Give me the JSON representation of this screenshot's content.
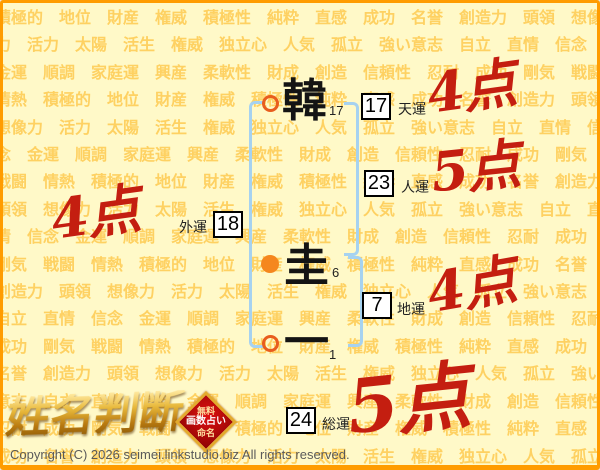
{
  "background": {
    "words": [
      "積極的",
      "地位",
      "財産",
      "権威",
      "積極性",
      "純粋",
      "直感",
      "成功",
      "名誉",
      "創造力",
      "頭領",
      "想像力",
      "活力",
      "太陽",
      "活生",
      "権威",
      "独立心",
      "人気",
      "孤立",
      "強い意志",
      "自立",
      "直情",
      "信念",
      "金運",
      "順調",
      "家庭運",
      "興産",
      "柔軟性",
      "財成",
      "創造",
      "信頼性",
      "忍耐",
      "成功",
      "剛気",
      "戦闘",
      "情熱"
    ]
  },
  "name": {
    "chars": [
      {
        "glyph": "韓",
        "strokes": "17"
      },
      {
        "glyph": "圭",
        "strokes": "6"
      },
      {
        "glyph": "一",
        "strokes": "1"
      }
    ]
  },
  "fortunes": [
    {
      "id": "tenun",
      "label": "天運",
      "value": "17",
      "score": "4点"
    },
    {
      "id": "jinun",
      "label": "人運",
      "value": "23",
      "score": "5点"
    },
    {
      "id": "gaiun",
      "label": "外運",
      "value": "18",
      "score": "4点"
    },
    {
      "id": "chiun",
      "label": "地運",
      "value": "7",
      "score": "4点"
    },
    {
      "id": "soun",
      "label": "総運",
      "value": "24",
      "score": "5点"
    }
  ],
  "logo": {
    "title": "姓名判断",
    "badge": [
      "無料",
      "画数占い",
      "命名"
    ]
  },
  "footer": {
    "copyright": "Copyright (C) 2026 seimei.linkstudio.biz All rights reserved."
  },
  "colors": {
    "border_orange": "#ff9c00",
    "bg_yellow": "#fff9c8",
    "word_orange": "#fed162",
    "bracket_blue": "#a6d2f0",
    "marker_orange": "#f5871e",
    "score_red": "#c41e10",
    "logo_gold": "#e8b93c"
  }
}
